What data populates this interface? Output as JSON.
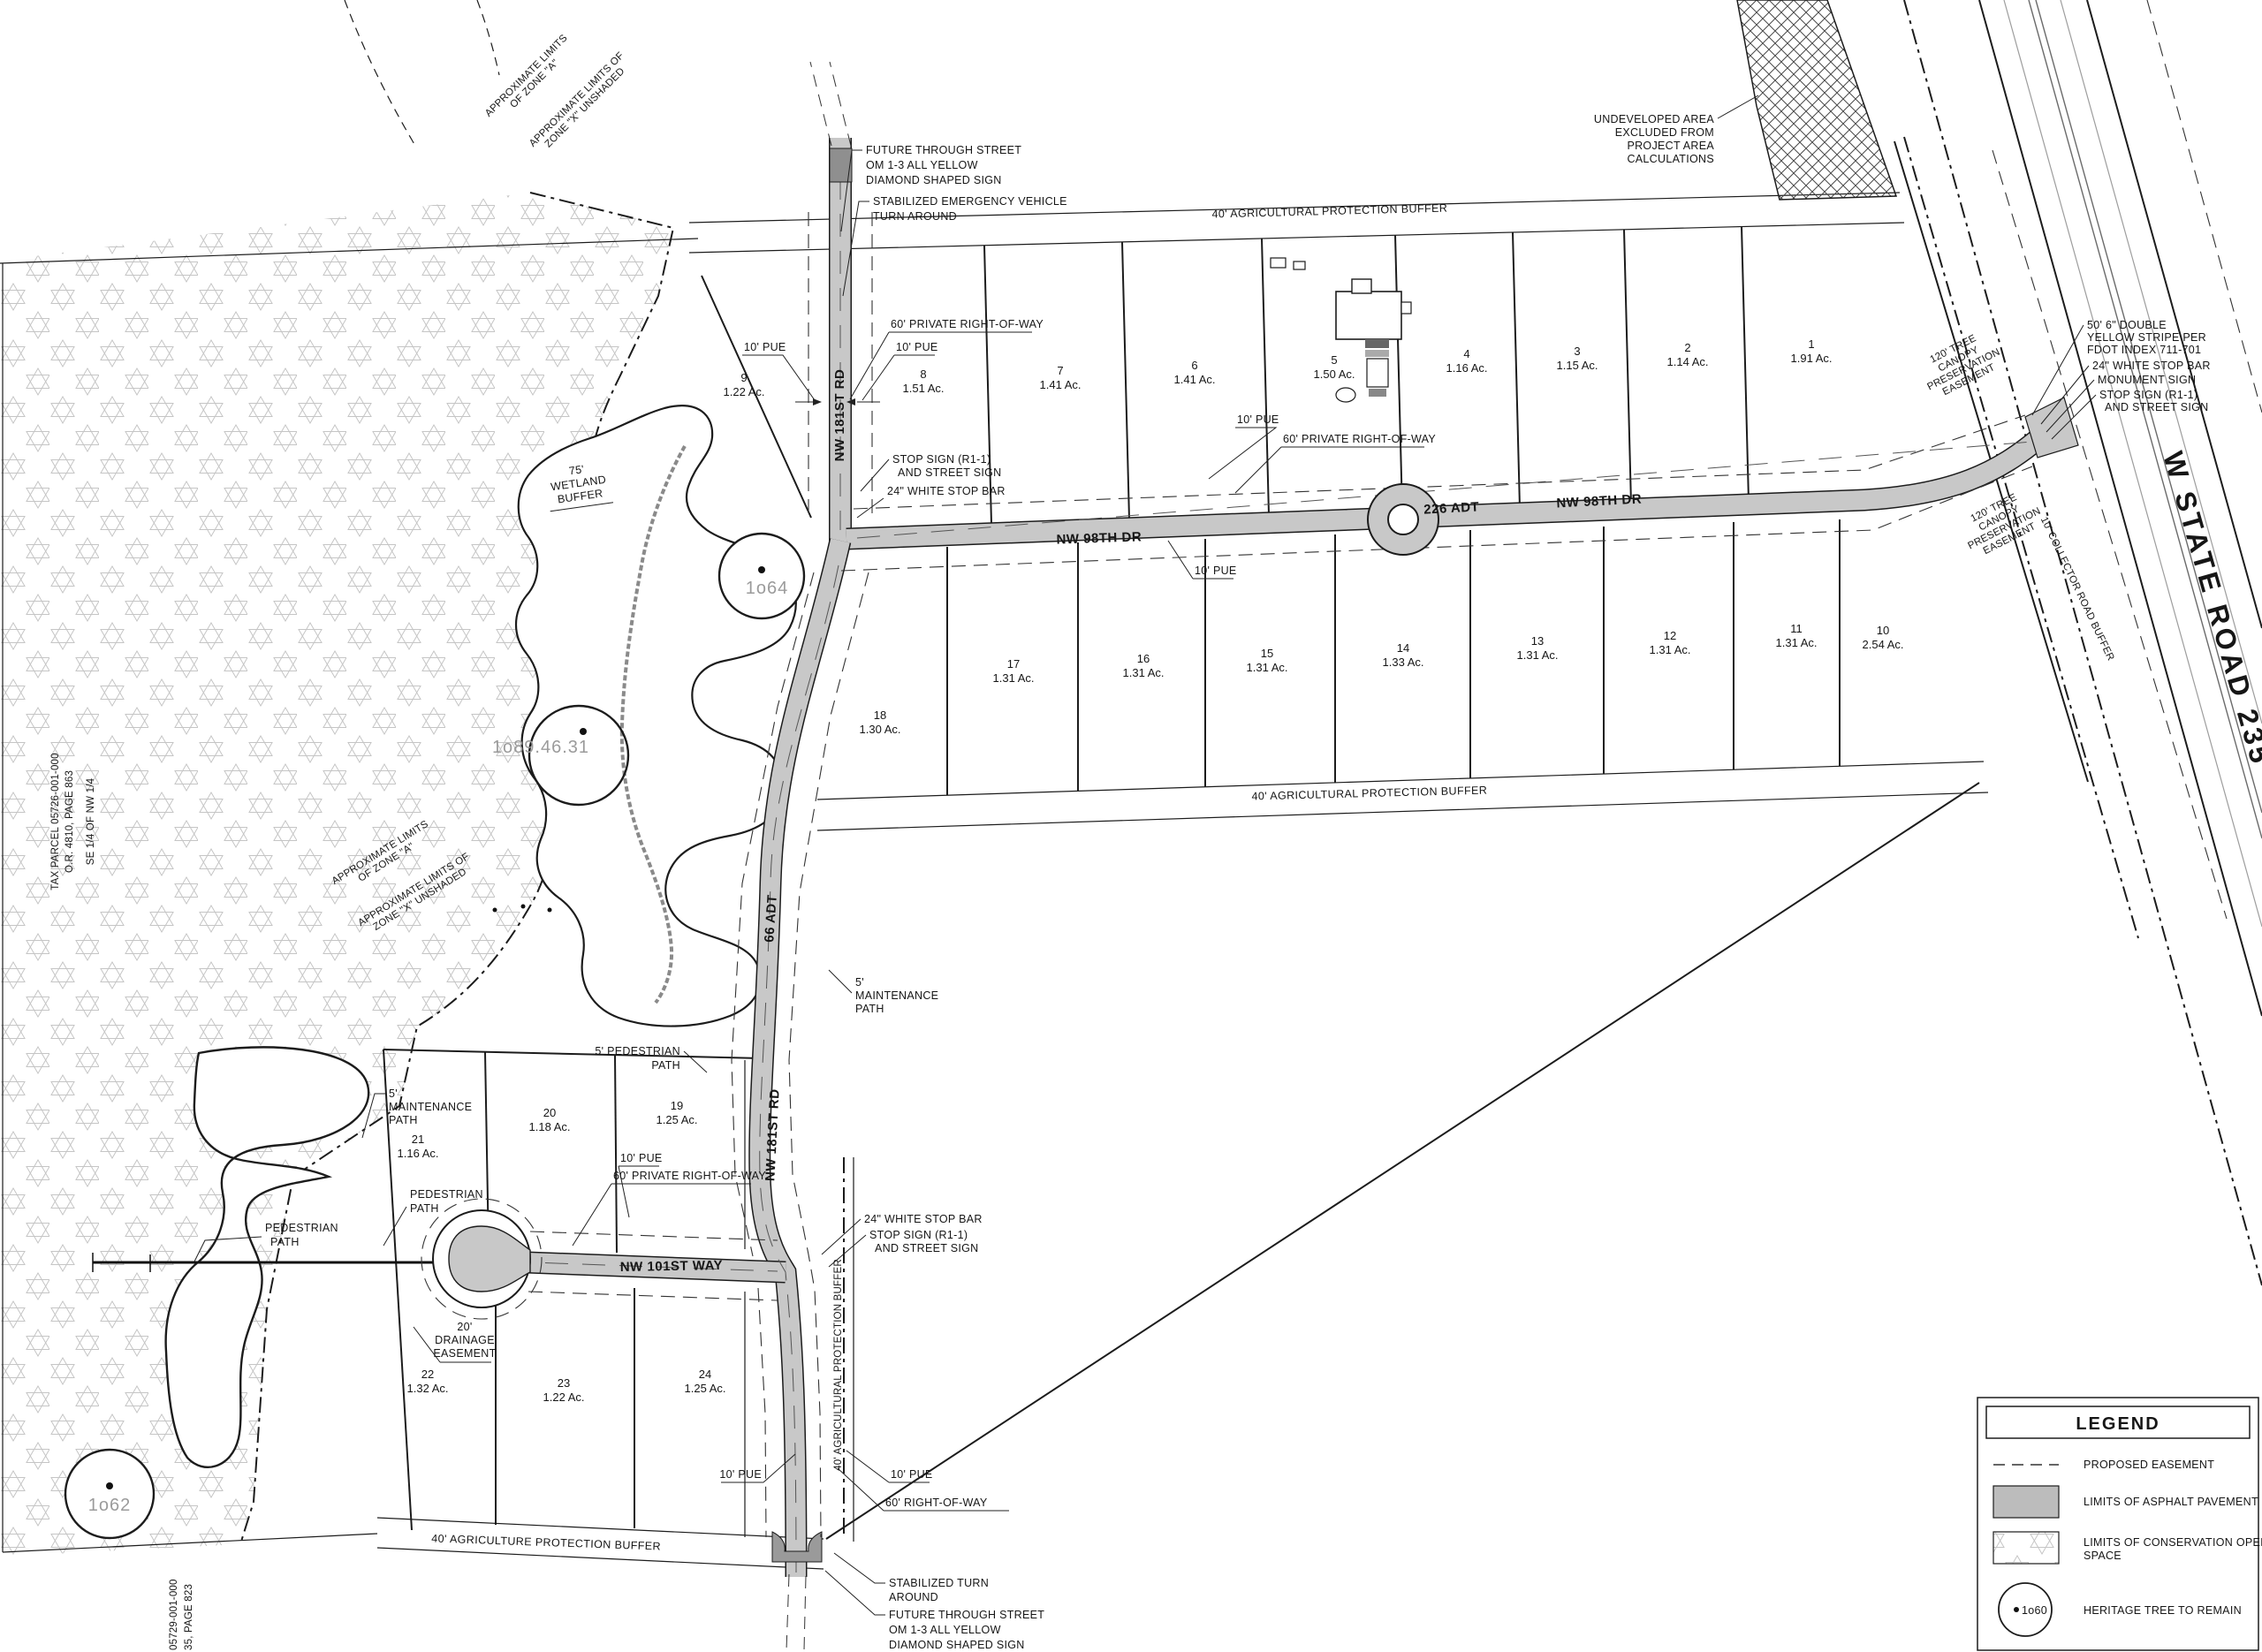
{
  "colors": {
    "asphalt": "#c8c8c8",
    "asphalt_dark": "#8f8f8f",
    "line": "#1c1c1c",
    "tree_label": "#9b9b9b"
  },
  "roads": {
    "nw98th_west": "NW 98TH DR",
    "nw98th_east": "NW 98TH DR",
    "adt_98": "226 ADT",
    "nw181st_north": "NW 181ST RD",
    "nw181st_south": "NW 181ST RD",
    "adt_181": "66 ADT",
    "nw101st": "NW 101ST WAY",
    "state_road": "W STATE ROAD 235"
  },
  "lots": [
    {
      "num": "1",
      "ac": "1.91 Ac."
    },
    {
      "num": "2",
      "ac": "1.14 Ac."
    },
    {
      "num": "3",
      "ac": "1.15 Ac."
    },
    {
      "num": "4",
      "ac": "1.16 Ac."
    },
    {
      "num": "5",
      "ac": "1.50 Ac."
    },
    {
      "num": "6",
      "ac": "1.41 Ac."
    },
    {
      "num": "7",
      "ac": "1.41 Ac."
    },
    {
      "num": "8",
      "ac": "1.51 Ac."
    },
    {
      "num": "9",
      "ac": "1.22 Ac."
    },
    {
      "num": "10",
      "ac": "2.54 Ac."
    },
    {
      "num": "11",
      "ac": "1.31 Ac."
    },
    {
      "num": "12",
      "ac": "1.31 Ac."
    },
    {
      "num": "13",
      "ac": "1.31 Ac."
    },
    {
      "num": "14",
      "ac": "1.33 Ac."
    },
    {
      "num": "15",
      "ac": "1.31 Ac."
    },
    {
      "num": "16",
      "ac": "1.31 Ac."
    },
    {
      "num": "17",
      "ac": "1.31 Ac."
    },
    {
      "num": "18",
      "ac": "1.30 Ac."
    },
    {
      "num": "19",
      "ac": "1.25 Ac."
    },
    {
      "num": "20",
      "ac": "1.18 Ac."
    },
    {
      "num": "21",
      "ac": "1.16 Ac."
    },
    {
      "num": "22",
      "ac": "1.32 Ac."
    },
    {
      "num": "23",
      "ac": "1.22 Ac."
    },
    {
      "num": "24",
      "ac": "1.25 Ac."
    }
  ],
  "buffers": {
    "top": "40' AGRICULTURAL PROTECTION BUFFER",
    "mid": "40' AGRICULTURAL PROTECTION BUFFER",
    "bottom": "40' AGRICULTURE PROTECTION BUFFER",
    "vertical": "40' AGRICULTURAL PROTECTION BUFFER",
    "wetland": [
      "75'",
      "WETLAND",
      "BUFFER"
    ],
    "collector": "10' COLLECTOR ROAD BUFFER"
  },
  "callouts": {
    "future_street_top": [
      "FUTURE THROUGH STREET",
      "OM 1-3 ALL YELLOW",
      "DIAMOND SHAPED SIGN"
    ],
    "evta": [
      "STABILIZED EMERGENCY VEHICLE",
      "TURN AROUND"
    ],
    "undeveloped": [
      "UNDEVELOPED AREA",
      "EXCLUDED FROM",
      "PROJECT AREA",
      "CALCULATIONS"
    ],
    "pue": "10' PUE",
    "private_row": "60' PRIVATE RIGHT-OF-WAY",
    "row60": "60' RIGHT-OF-WAY",
    "stop_sign": [
      "STOP SIGN (R1-1)",
      "AND STREET SIGN"
    ],
    "stop_bar": "24\" WHITE STOP BAR",
    "double_yellow": [
      "50' 6\" DOUBLE",
      "YELLOW STRIPE PER",
      "FDOT INDEX 711-701"
    ],
    "monument": "MONUMENT SIGN",
    "tree_canopy": [
      "120' TREE",
      "CANOPY",
      "PRESERVATION",
      "EASEMENT"
    ],
    "maintenance_path": [
      "5'",
      "MAINTENANCE",
      "PATH"
    ],
    "pedestrian_path_5": [
      "5' PEDESTRIAN",
      "PATH"
    ],
    "pedestrian_path": [
      "PEDESTRIAN",
      "PATH"
    ],
    "drainage": [
      "20'",
      "DRAINAGE",
      "EASEMENT"
    ],
    "stabilized_turn": [
      "STABILIZED TURN",
      "AROUND"
    ],
    "future_street_bottom": [
      "FUTURE THROUGH STREET",
      "OM 1-3 ALL YELLOW",
      "DIAMOND SHAPED SIGN"
    ],
    "zone_a": [
      "APPROXIMATE LIMITS",
      "OF ZONE \"A\""
    ],
    "zone_x": [
      "APPROXIMATE LIMITS OF",
      "ZONE \"X\" UNSHADED"
    ]
  },
  "parcels": {
    "left_line1": "TAX PARCEL 05726-001-000",
    "left_line2": "O.R. 4810, PAGE 863",
    "left_line3": "SE 1/4 OF NW 1/4",
    "bottom_line1": "05729-001-000",
    "bottom_line2": "35, PAGE 823"
  },
  "trees": {
    "t64": "1o64",
    "t89": "1o89.46.31",
    "t62": "1o62"
  },
  "legend": {
    "title": "LEGEND",
    "item_easement": "PROPOSED EASEMENT",
    "item_asphalt": "LIMITS OF ASPHALT PAVEMENT",
    "item_conservation_1": "LIMITS OF CONSERVATION OPEN",
    "item_conservation_2": "SPACE",
    "item_tree": "HERITAGE TREE TO REMAIN",
    "tree_tag": "1o60"
  }
}
